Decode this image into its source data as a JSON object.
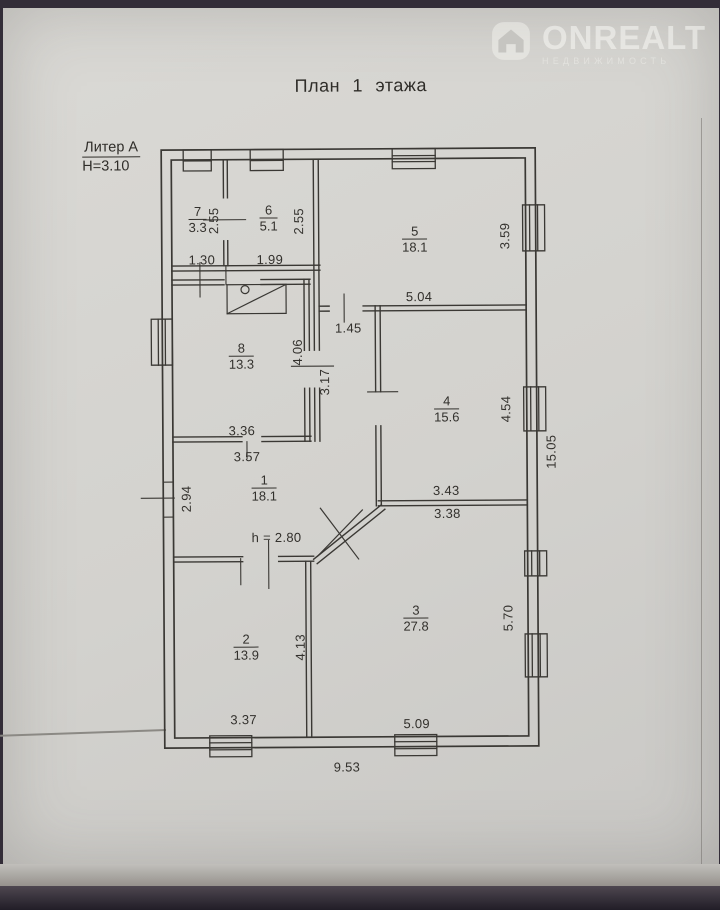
{
  "page": {
    "title": "План 1 этажа"
  },
  "watermark": {
    "brand": "ONREALT",
    "tagline": "НЕДВИЖИМОСТЬ"
  },
  "building": {
    "liter": "Литер А",
    "floor_height": "Н=3.10"
  },
  "rooms": {
    "r1": {
      "num": "1",
      "area": "18.1"
    },
    "r2": {
      "num": "2",
      "area": "13.9"
    },
    "r3": {
      "num": "3",
      "area": "27.8"
    },
    "r4": {
      "num": "4",
      "area": "15.6"
    },
    "r5": {
      "num": "5",
      "area": "18.1"
    },
    "r6": {
      "num": "6",
      "area": "5.1"
    },
    "r7": {
      "num": "7",
      "area": "3.3"
    },
    "r8": {
      "num": "8",
      "area": "13.3"
    }
  },
  "dims": {
    "room7_w": "1.30",
    "room6_w": "1.99",
    "room7_h": "2.55",
    "room6_h": "2.55",
    "room5_w": "5.04",
    "room5_h": "3.59",
    "hall_w": "1.45",
    "hall_h": "3.17",
    "room8_e": "4.06",
    "room8_w": "3.36",
    "room8_w_ext": "3.57",
    "room1_h": "2.94",
    "room1_ceiling": "h = 2.80",
    "room4_w": "3.43",
    "room4_w_ext": "3.38",
    "room4_h": "4.54",
    "room2_h": "4.13",
    "room2_w": "3.37",
    "room3_w": "5.09",
    "room3_h": "5.70",
    "total_w": "9.53",
    "total_h": "15.05"
  },
  "colors": {
    "paper": "#d5d4d0",
    "ink": "#3a3834",
    "backdrop": "#332d38"
  }
}
